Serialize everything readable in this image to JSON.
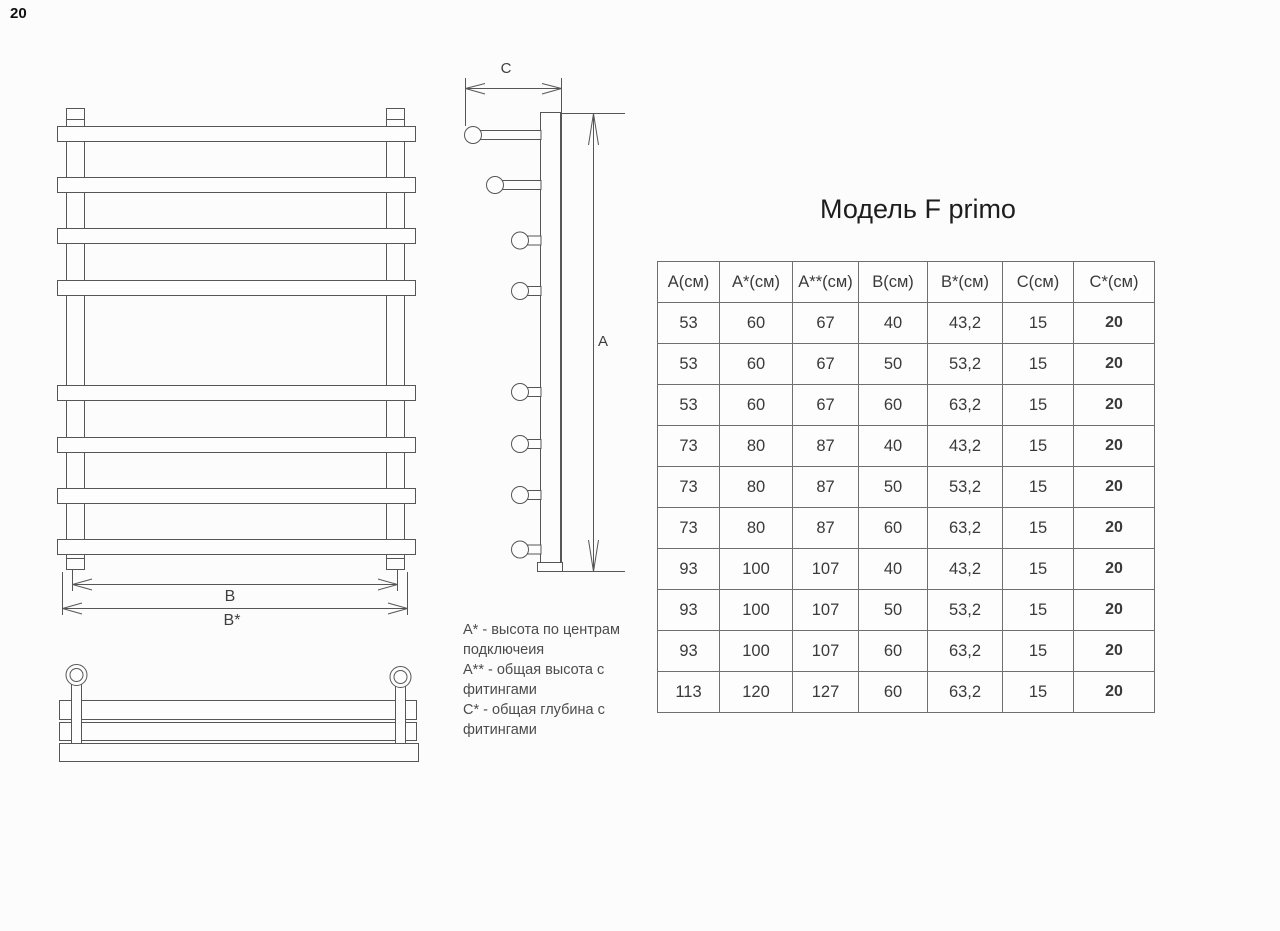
{
  "page": {
    "number": "20"
  },
  "title": "Модель F primo",
  "table": {
    "headers": [
      "А(см)",
      "А*(см)",
      "А**(см)",
      "В(см)",
      "В*(см)",
      "С(см)",
      "С*(см)"
    ],
    "rows": [
      [
        "53",
        "60",
        "67",
        "40",
        "43,2",
        "15",
        "20"
      ],
      [
        "53",
        "60",
        "67",
        "50",
        "53,2",
        "15",
        "20"
      ],
      [
        "53",
        "60",
        "67",
        "60",
        "63,2",
        "15",
        "20"
      ],
      [
        "73",
        "80",
        "87",
        "40",
        "43,2",
        "15",
        "20"
      ],
      [
        "73",
        "80",
        "87",
        "50",
        "53,2",
        "15",
        "20"
      ],
      [
        "73",
        "80",
        "87",
        "60",
        "63,2",
        "15",
        "20"
      ],
      [
        "93",
        "100",
        "107",
        "40",
        "43,2",
        "15",
        "20"
      ],
      [
        "93",
        "100",
        "107",
        "50",
        "53,2",
        "15",
        "20"
      ],
      [
        "93",
        "100",
        "107",
        "60",
        "63,2",
        "15",
        "20"
      ],
      [
        "113",
        "120",
        "127",
        "60",
        "63,2",
        "15",
        "20"
      ]
    ]
  },
  "dimensions": {
    "a": "A",
    "b": "B",
    "b_star": "B*",
    "c": "C"
  },
  "notes": [
    "А* - высота по центрам подключеия",
    "А** - общая высота с фитингами",
    "С* - общая глубина с фитингами"
  ],
  "colors": {
    "line": "#565656",
    "table_border": "#6f6f6f",
    "text": "#3a3a3a"
  }
}
